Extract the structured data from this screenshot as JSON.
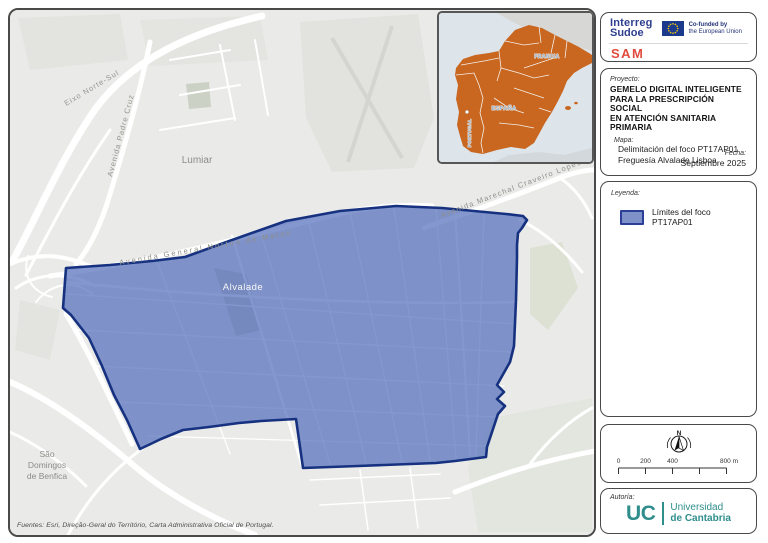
{
  "logo_panel": {
    "interreg": "Interreg",
    "sudoe": "Sudoe",
    "eu_cofunded_line1": "Co-funded by",
    "eu_cofunded_line2": "the European Union",
    "program": "SAM"
  },
  "project_panel": {
    "label": "Proyecto:",
    "title_line1": "GEMELO DIGITAL INTELIGENTE",
    "title_line2": "PARA LA PRESCRIPCIÓN SOCIAL",
    "title_line3": "EN ATENCIÓN SANITARIA PRIMARIA",
    "map_label": "Mapa:",
    "map_line1": "Delimitación del foco PT17AP01",
    "map_line2": "Freguesía Alvalade Lisboa",
    "date_label": "Fecha:",
    "date_value": "Septiembre 2025"
  },
  "legend_panel": {
    "label": "Leyenda:",
    "item_label": "Límites del foco PT17AP01",
    "swatch_fill": "#7e92c9",
    "swatch_border": "#2b3f96"
  },
  "scale_panel": {
    "north_label": "N",
    "tick0": "0",
    "tick200": "200",
    "tick400": "400",
    "tick800": "800 m"
  },
  "authorship_panel": {
    "label": "Autoría:",
    "org_abbr": "UC",
    "org_line1": "Universidad",
    "org_line2": "de Cantabria"
  },
  "map": {
    "labels": {
      "lumiar": "Lumiar",
      "alvalade": "Alvalade",
      "sao_line1": "São",
      "sao_line2": "Domingos",
      "sao_line3": "de Benfica",
      "eixo_norte_sul": "Eixo Norte-Sul",
      "avenida_padre_cruz": "Avenida Padre Cruz",
      "avenida_norton": "Avenida General Norton de Matos",
      "avenida_craveiro": "Avenida Marechal Craveiro Lopes"
    },
    "sources": "Fuentes: Esri, Direção-Geral do Território, Carta Administrativa Oficial de Portugal."
  },
  "inset": {
    "francia": "FRANCIA",
    "espana": "ESPAÑA",
    "portugal": "PORTUGAL",
    "region_color": "#c9661f"
  },
  "colors": {
    "polygon_fill": "#5470bd",
    "polygon_stroke": "#16317f",
    "interreg_blue": "#2e3f8f",
    "sam_red": "#e14b3d",
    "uc_teal": "#2f8e8c",
    "sudoe_orange": "#c9661f"
  }
}
